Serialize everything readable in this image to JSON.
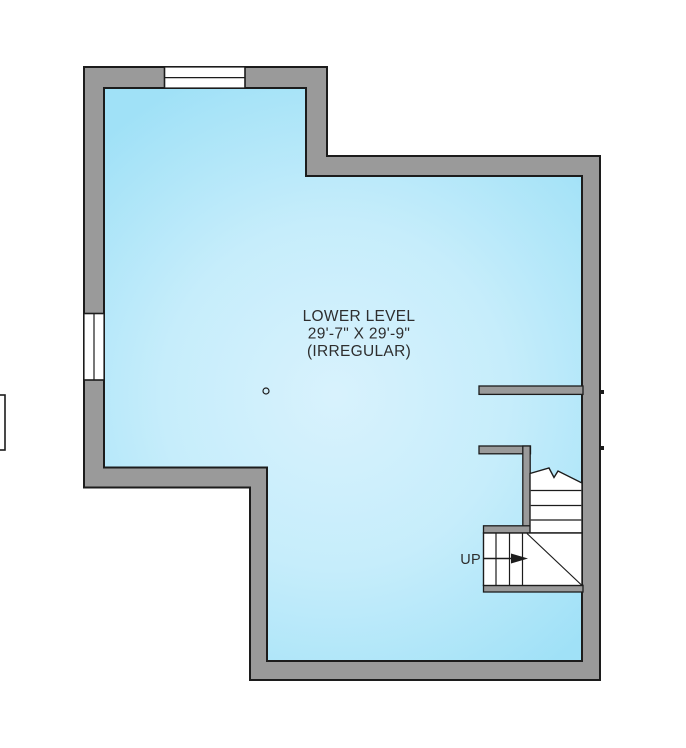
{
  "plan": {
    "room_label": "LOWER LEVEL",
    "room_dimensions": "29'-7\" X 29'-9\"",
    "room_note": "(IRREGULAR)",
    "stairs_label": "UP"
  },
  "symbols": {
    "column_icon": "small-circle",
    "up_arrow_icon": "right-pointing-arrow",
    "stair_break_line_icon": "zigzag-break-line"
  },
  "colors": {
    "background": "#ffffff",
    "wall_fill": "#9a9a9a",
    "wall_outline": "#1c1c1c",
    "floor_center": "#d8f2fd",
    "floor_mid": "#c6edfb",
    "floor_edge": "#a0e1f7",
    "window_fill": "#ffffff",
    "stair_fill": "#ffffff",
    "label_color": "#2e2e2e"
  }
}
